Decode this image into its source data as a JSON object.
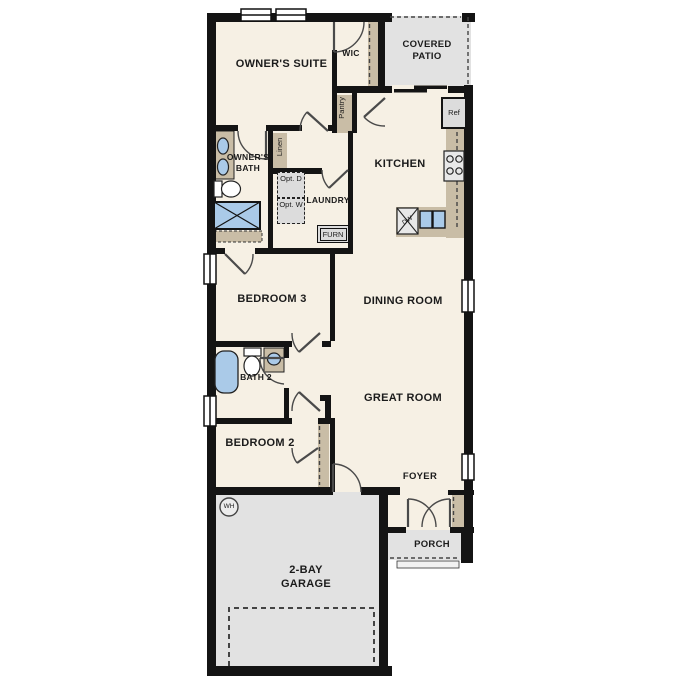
{
  "plan_type": "single-story residential floor plan",
  "rooms": {
    "owners_suite": "OWNER'S SUITE",
    "wic": "WIC",
    "covered_patio": "COVERED PATIO",
    "kitchen": "KITCHEN",
    "owners_bath": "OWNER'S BATH",
    "pantry": "Pantry",
    "linen": "Linen",
    "laundry": "LAUNDRY",
    "bedroom_3": "BEDROOM 3",
    "dining_room": "DINING ROOM",
    "bath_2": "BATH 2",
    "great_room": "GREAT ROOM",
    "bedroom_2": "BEDROOM 2",
    "foyer": "FOYER",
    "porch": "PORCH",
    "garage": "2-BAY GARAGE"
  },
  "appliances": {
    "refrigerator": "Ref",
    "dishwasher": "DW",
    "furnace": "FURN",
    "optional_dryer": "Opt. D",
    "optional_washer": "Opt. W",
    "water_heater": "WH"
  },
  "colors": {
    "floor": "#f6f0e4",
    "outdoor_concrete": "#e2e2e2",
    "cabinet_tan": "#c9bda6",
    "fixture_blue": "#aacae8",
    "wall_black": "#141414"
  }
}
